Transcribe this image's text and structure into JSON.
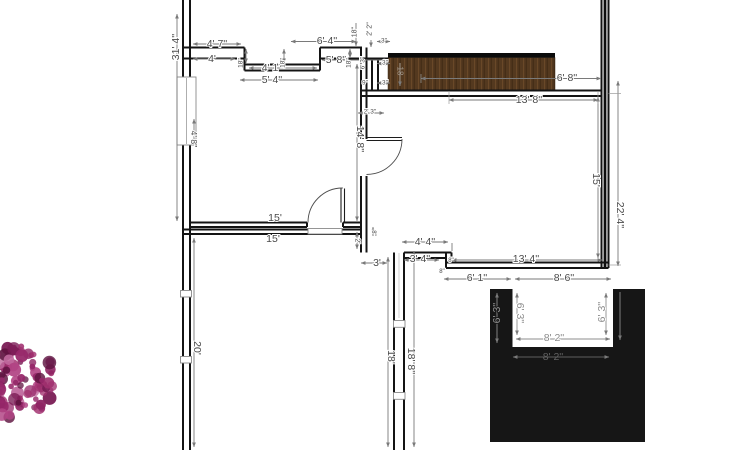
{
  "drawing": {
    "kind": "residential floor plan with deck stairs, patio area and shrub",
    "colors": {
      "background": "#ffffff",
      "wall": "#141414",
      "dimension_text": "#4a4a4a",
      "dimension_line": "#7a7a7a",
      "deck_edge": "#0b0b0b",
      "wood_base": "#54391f",
      "wood_dark": "#432c16",
      "wood_light": "#6b4a28",
      "black_area": "#161616",
      "notch": "#ffffff"
    },
    "deck": {
      "grain_label": "18"
    },
    "labels": [
      {
        "t": "31' 4''",
        "x": 176,
        "y": 47,
        "r": -90
      },
      {
        "t": "4' 7''",
        "x": 217,
        "y": 44
      },
      {
        "t": "4'",
        "x": 212,
        "y": 59
      },
      {
        "t": "6' 4''",
        "x": 327,
        "y": 41
      },
      {
        "t": "5' 8''",
        "x": 336,
        "y": 60
      },
      {
        "t": "4' 1''",
        "x": 272,
        "y": 68
      },
      {
        "t": "5' 4''",
        "x": 272,
        "y": 80
      },
      {
        "t": "18''",
        "x": 241,
        "y": 63,
        "r": -90,
        "s": 6.5
      },
      {
        "t": "18''",
        "x": 283,
        "y": 63,
        "r": -90,
        "s": 6.5
      },
      {
        "t": "18''",
        "x": 349,
        "y": 63,
        "r": -90,
        "s": 6.5
      },
      {
        "t": "18''",
        "x": 355,
        "y": 32,
        "r": -90,
        "s": 7
      },
      {
        "t": "2' 2''",
        "x": 370,
        "y": 29,
        "r": -90,
        "s": 7
      },
      {
        "t": "3''",
        "x": 384,
        "y": 41,
        "s": 6.5
      },
      {
        "t": "6' 3''",
        "x": 363,
        "y": 63,
        "r": -90,
        "s": 6.5
      },
      {
        "t": "3''",
        "x": 385,
        "y": 63,
        "s": 6.5
      },
      {
        "t": "9''",
        "x": 365,
        "y": 83,
        "s": 6.5
      },
      {
        "t": "3''",
        "x": 385,
        "y": 83,
        "s": 6.5
      },
      {
        "t": "2' 3''",
        "x": 370,
        "y": 112,
        "s": 6.5
      },
      {
        "t": "18",
        "x": 400,
        "y": 71,
        "r": 90,
        "s": 8,
        "c": "#a0968b",
        "h": "none"
      },
      {
        "t": "6' 8''",
        "x": 567,
        "y": 78
      },
      {
        "t": "13' 8''",
        "x": 529,
        "y": 100
      },
      {
        "t": "14' 8''",
        "x": 360,
        "y": 139,
        "r": 90
      },
      {
        "t": "4' 8''",
        "x": 194,
        "y": 139,
        "r": 90,
        "s": 8.5
      },
      {
        "t": "15'",
        "x": 275,
        "y": 218
      },
      {
        "t": "15'",
        "x": 273,
        "y": 239
      },
      {
        "t": "15'",
        "x": 596,
        "y": 180,
        "r": 90
      },
      {
        "t": "22' 4''",
        "x": 620,
        "y": 215,
        "r": 90
      },
      {
        "t": "2'",
        "x": 357,
        "y": 241,
        "r": 90,
        "s": 7
      },
      {
        "t": "8''",
        "x": 373,
        "y": 233,
        "r": 90,
        "s": 6
      },
      {
        "t": "4' 4''",
        "x": 425,
        "y": 242
      },
      {
        "t": "3'",
        "x": 377,
        "y": 263
      },
      {
        "t": "3' 4''",
        "x": 420,
        "y": 259
      },
      {
        "t": "8''",
        "x": 451,
        "y": 261,
        "s": 6
      },
      {
        "t": "8''",
        "x": 442,
        "y": 272,
        "s": 6
      },
      {
        "t": "13' 4''",
        "x": 526,
        "y": 259
      },
      {
        "t": "6' 1''",
        "x": 477,
        "y": 278
      },
      {
        "t": "8' 6''",
        "x": 564,
        "y": 278
      },
      {
        "t": "20'",
        "x": 197,
        "y": 348,
        "r": 90
      },
      {
        "t": "18'",
        "x": 391,
        "y": 357,
        "r": 90
      },
      {
        "t": "18' 8''",
        "x": 411,
        "y": 361,
        "r": 90
      },
      {
        "t": "6' 3''",
        "x": 497,
        "y": 313,
        "r": -90,
        "c": "#929292",
        "h": "#161616"
      },
      {
        "t": "6' 3''",
        "x": 520,
        "y": 313,
        "r": 90,
        "c": "#8c8c8c"
      },
      {
        "t": "6' 3''",
        "x": 602,
        "y": 312,
        "r": -90,
        "c": "#8c8c8c"
      },
      {
        "t": "8' 2''",
        "x": 554,
        "y": 338,
        "c": "#8c8c8c"
      },
      {
        "t": "8' 2''",
        "x": 553,
        "y": 357,
        "c": "#616161",
        "h": "none"
      }
    ],
    "flower": {
      "cx": 18,
      "cy": 381,
      "r": 38,
      "count": 95,
      "palette": [
        "#8e2463",
        "#7a1c55",
        "#a1306f",
        "#b24484",
        "#5e1340",
        "#c06a9e",
        "#97286a"
      ]
    }
  }
}
